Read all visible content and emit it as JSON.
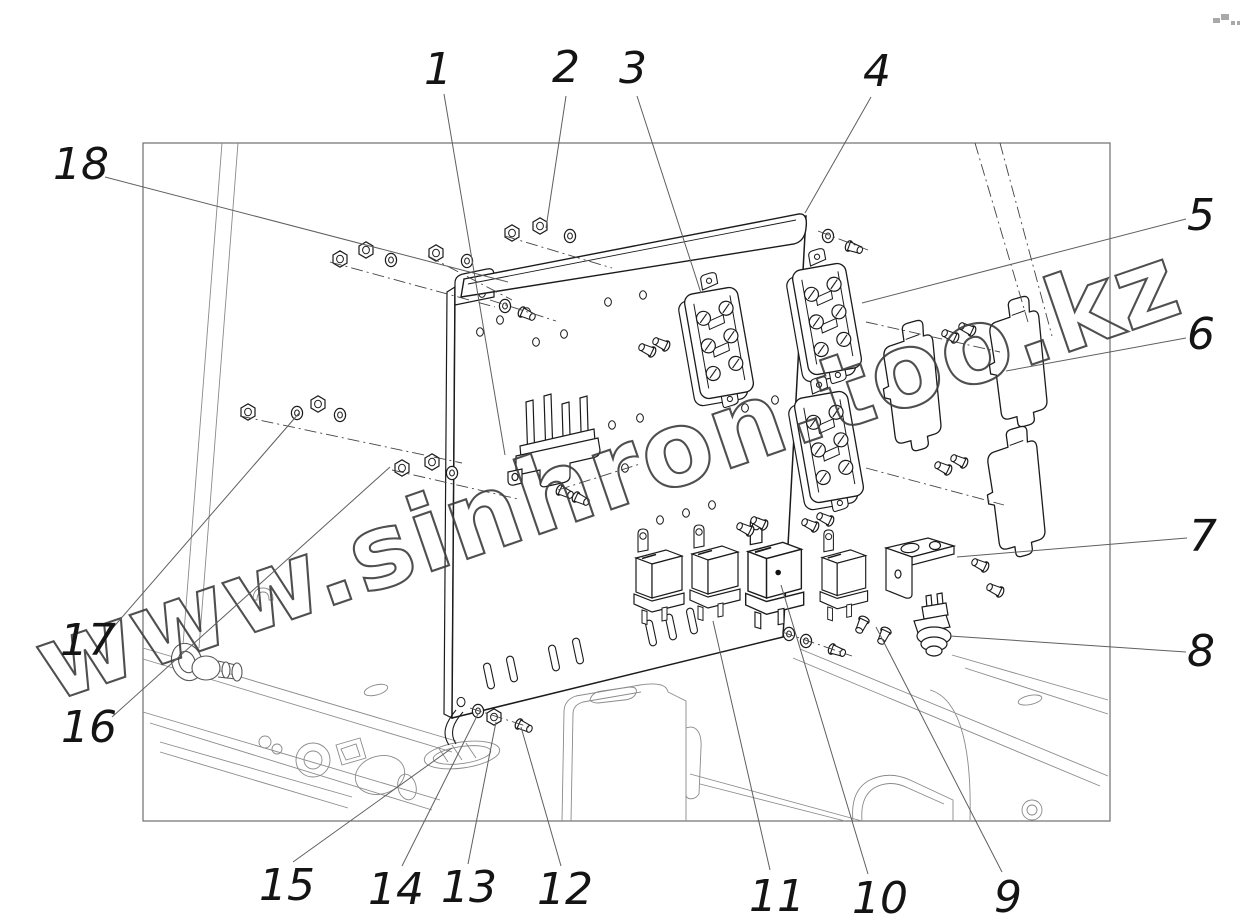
{
  "figure": {
    "kind": "exploded-parts-diagram",
    "subject": "electrical equipment panel assembly",
    "background": "#ffffff",
    "line_color": "#1b1b1b",
    "chassis_line_color": "#8a8a8a",
    "leader_color": "#5f5f5f"
  },
  "watermark": {
    "text": "www.sinhron.too.kz",
    "color": "#3d3d3d",
    "rotation_deg": -19,
    "font_size": 104
  },
  "callouts": [
    {
      "label": "1",
      "tx": 438,
      "ty": 68,
      "lead": [
        [
          444,
          94
        ],
        [
          505,
          455
        ]
      ]
    },
    {
      "label": "2",
      "tx": 566,
      "ty": 66,
      "lead": [
        [
          566,
          96
        ],
        [
          546,
          228
        ]
      ]
    },
    {
      "label": "3",
      "tx": 633,
      "ty": 67,
      "lead": [
        [
          637,
          96
        ],
        [
          701,
          293
        ]
      ]
    },
    {
      "label": "4",
      "tx": 877,
      "ty": 70,
      "lead": [
        [
          871,
          97
        ],
        [
          805,
          213
        ]
      ]
    },
    {
      "label": "5",
      "tx": 1201,
      "ty": 214,
      "lead": [
        [
          1186,
          219
        ],
        [
          862,
          303
        ]
      ]
    },
    {
      "label": "6",
      "tx": 1201,
      "ty": 333,
      "lead": [
        [
          1186,
          338
        ],
        [
          1006,
          371
        ]
      ]
    },
    {
      "label": "7",
      "tx": 1203,
      "ty": 535,
      "lead": [
        [
          1187,
          538
        ],
        [
          957,
          557
        ]
      ]
    },
    {
      "label": "8",
      "tx": 1201,
      "ty": 650,
      "lead": [
        [
          1186,
          652
        ],
        [
          950,
          636
        ]
      ]
    },
    {
      "label": "9",
      "tx": 1008,
      "ty": 896,
      "lead": [
        [
          1002,
          872
        ],
        [
          876,
          627
        ]
      ]
    },
    {
      "label": "10",
      "tx": 880,
      "ty": 897,
      "lead": [
        [
          868,
          874
        ],
        [
          781,
          585
        ]
      ]
    },
    {
      "label": "11",
      "tx": 777,
      "ty": 895,
      "lead": [
        [
          770,
          870
        ],
        [
          713,
          621
        ]
      ]
    },
    {
      "label": "12",
      "tx": 565,
      "ty": 888,
      "lead": [
        [
          561,
          866
        ],
        [
          521,
          727
        ]
      ]
    },
    {
      "label": "13",
      "tx": 469,
      "ty": 886,
      "lead": [
        [
          468,
          864
        ],
        [
          496,
          722
        ]
      ]
    },
    {
      "label": "14",
      "tx": 396,
      "ty": 888,
      "lead": [
        [
          402,
          866
        ],
        [
          478,
          714
        ]
      ]
    },
    {
      "label": "15",
      "tx": 287,
      "ty": 884,
      "lead": [
        [
          293,
          862
        ],
        [
          452,
          748
        ]
      ]
    },
    {
      "label": "16",
      "tx": 89,
      "ty": 726,
      "lead": [
        [
          112,
          717
        ],
        [
          390,
          467
        ]
      ]
    },
    {
      "label": "17",
      "tx": 88,
      "ty": 639,
      "lead": [
        [
          111,
          630
        ],
        [
          300,
          412
        ]
      ]
    },
    {
      "label": "18",
      "tx": 81,
      "ty": 163,
      "lead": [
        [
          105,
          177
        ],
        [
          508,
          282
        ]
      ]
    }
  ]
}
